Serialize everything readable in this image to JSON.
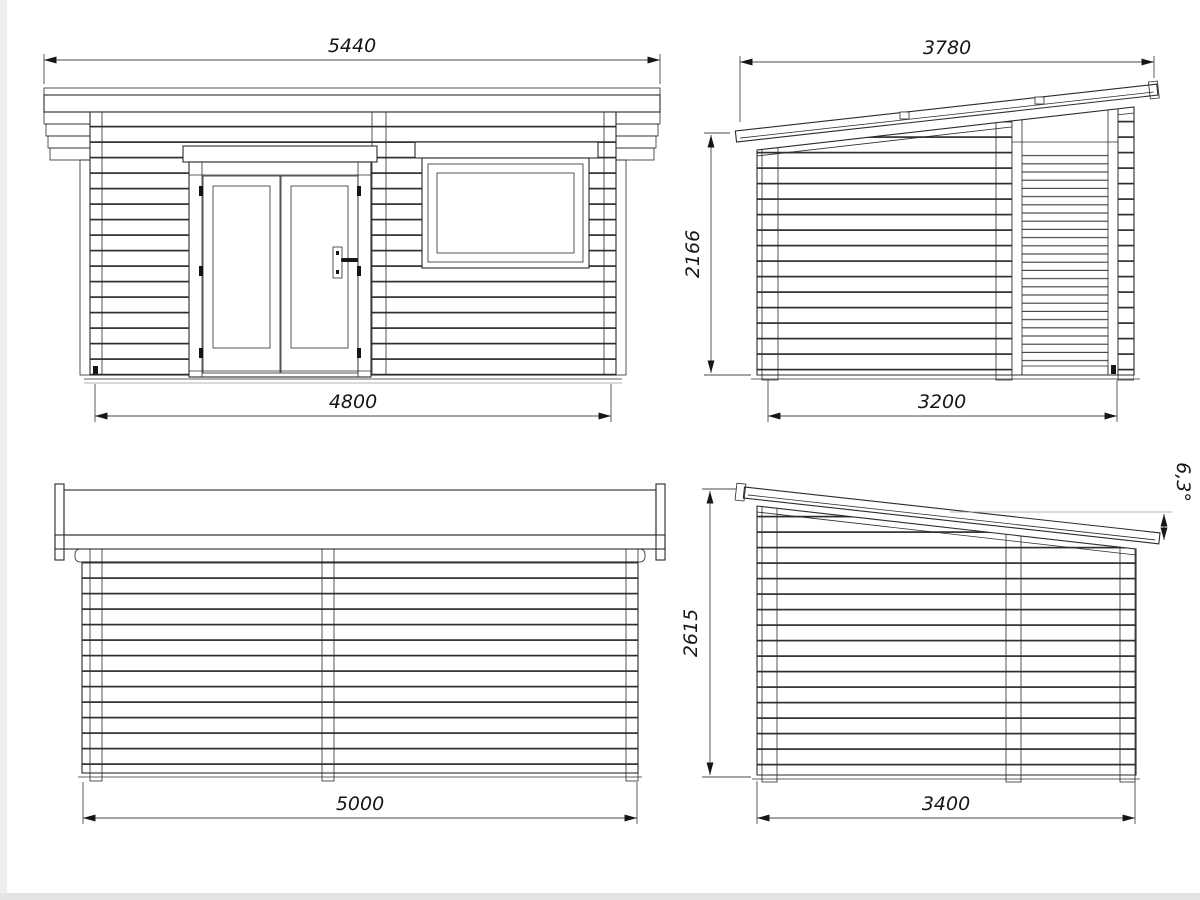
{
  "style": {
    "background": "#ffffff",
    "line_color": "#2b2b2b",
    "dimension_text_color": "#161616",
    "edge_strip_color": "#ededed"
  },
  "views": {
    "front": {
      "dim_roof_width": "5440",
      "dim_wall_width": "4800"
    },
    "side_right": {
      "dim_roof_length": "3780",
      "dim_wall_height": "2166",
      "dim_wall_length": "3200"
    },
    "rear": {
      "dim_wall_width": "5000"
    },
    "side_left": {
      "dim_wall_height": "2615",
      "dim_wall_length": "3400",
      "dim_roof_angle": "6,3°"
    }
  }
}
